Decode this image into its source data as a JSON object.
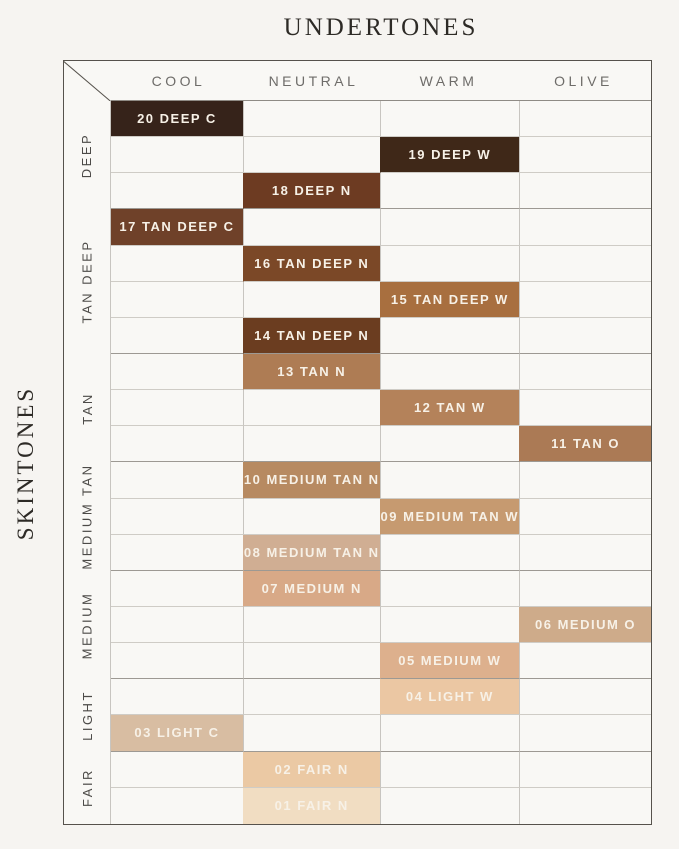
{
  "title": "UNDERTONES",
  "side_title": "SKINTONES",
  "chart_data": {
    "type": "heatmap",
    "title": "UNDERTONES",
    "x_axis_label": "UNDERTONES",
    "y_axis_label": "SKINTONES",
    "x_categories": [
      "COOL",
      "NEUTRAL",
      "WARM",
      "OLIVE"
    ],
    "y_groups": [
      {
        "label": "DEEP",
        "rows": 3
      },
      {
        "label": "TAN DEEP",
        "rows": 4
      },
      {
        "label": "TAN",
        "rows": 3
      },
      {
        "label": "MEDIUM TAN",
        "rows": 3
      },
      {
        "label": "MEDIUM",
        "rows": 3
      },
      {
        "label": "LIGHT",
        "rows": 2
      },
      {
        "label": "FAIR",
        "rows": 2
      }
    ],
    "num_rows": 20,
    "cell_text_color": "#f7f1e7",
    "cells": [
      {
        "row": 1,
        "undertone": "COOL",
        "skintone": "DEEP",
        "label": "20 DEEP C",
        "color": "#36231a"
      },
      {
        "row": 2,
        "undertone": "WARM",
        "skintone": "DEEP",
        "label": "19 DEEP W",
        "color": "#3f2818"
      },
      {
        "row": 3,
        "undertone": "NEUTRAL",
        "skintone": "DEEP",
        "label": "18 DEEP N",
        "color": "#6d3b22"
      },
      {
        "row": 4,
        "undertone": "COOL",
        "skintone": "TAN DEEP",
        "label": "17 TAN DEEP C",
        "color": "#6f4129"
      },
      {
        "row": 5,
        "undertone": "NEUTRAL",
        "skintone": "TAN DEEP",
        "label": "16 TAN DEEP N",
        "color": "#7b4827"
      },
      {
        "row": 6,
        "undertone": "WARM",
        "skintone": "TAN DEEP",
        "label": "15 TAN DEEP W",
        "color": "#a86f3f"
      },
      {
        "row": 7,
        "undertone": "NEUTRAL",
        "skintone": "TAN DEEP",
        "label": "14 TAN DEEP N",
        "color": "#6b3d20"
      },
      {
        "row": 8,
        "undertone": "NEUTRAL",
        "skintone": "TAN",
        "label": "13 TAN N",
        "color": "#ae7c54"
      },
      {
        "row": 9,
        "undertone": "WARM",
        "skintone": "TAN",
        "label": "12 TAN W",
        "color": "#b4825a"
      },
      {
        "row": 10,
        "undertone": "OLIVE",
        "skintone": "TAN",
        "label": "11 TAN O",
        "color": "#ab7a55"
      },
      {
        "row": 11,
        "undertone": "NEUTRAL",
        "skintone": "MEDIUM TAN",
        "label": "10 MEDIUM TAN N",
        "color": "#b78a61"
      },
      {
        "row": 12,
        "undertone": "WARM",
        "skintone": "MEDIUM TAN",
        "label": "09 MEDIUM TAN W",
        "color": "#c69a70"
      },
      {
        "row": 13,
        "undertone": "NEUTRAL",
        "skintone": "MEDIUM TAN",
        "label": "08 MEDIUM TAN N",
        "color": "#d0ae93"
      },
      {
        "row": 14,
        "undertone": "NEUTRAL",
        "skintone": "MEDIUM",
        "label": "07 MEDIUM N",
        "color": "#d8a987"
      },
      {
        "row": 15,
        "undertone": "OLIVE",
        "skintone": "MEDIUM",
        "label": "06 MEDIUM O",
        "color": "#ceab8a"
      },
      {
        "row": 16,
        "undertone": "WARM",
        "skintone": "MEDIUM",
        "label": "05 MEDIUM W",
        "color": "#ddb08d"
      },
      {
        "row": 17,
        "undertone": "WARM",
        "skintone": "LIGHT",
        "label": "04 LIGHT W",
        "color": "#ebc7a3"
      },
      {
        "row": 18,
        "undertone": "COOL",
        "skintone": "LIGHT",
        "label": "03 LIGHT C",
        "color": "#d8bda2"
      },
      {
        "row": 19,
        "undertone": "NEUTRAL",
        "skintone": "FAIR",
        "label": "02 FAIR N",
        "color": "#ebc9a4"
      },
      {
        "row": 20,
        "undertone": "NEUTRAL",
        "skintone": "FAIR",
        "label": "01 FAIR N",
        "color": "#f1ddc2"
      }
    ]
  },
  "colors": {
    "background": "#f6f4f1",
    "table_background": "#f9f8f5",
    "outer_border": "#56524c",
    "header_underline": "#8f8b85",
    "grid_line": "#cfccc6",
    "group_line": "#9d9993",
    "column_line": "#c8c5c0",
    "header_text": "#6e6c69",
    "group_label_text": "#4c4a47",
    "title_text": "#2d2a26"
  }
}
